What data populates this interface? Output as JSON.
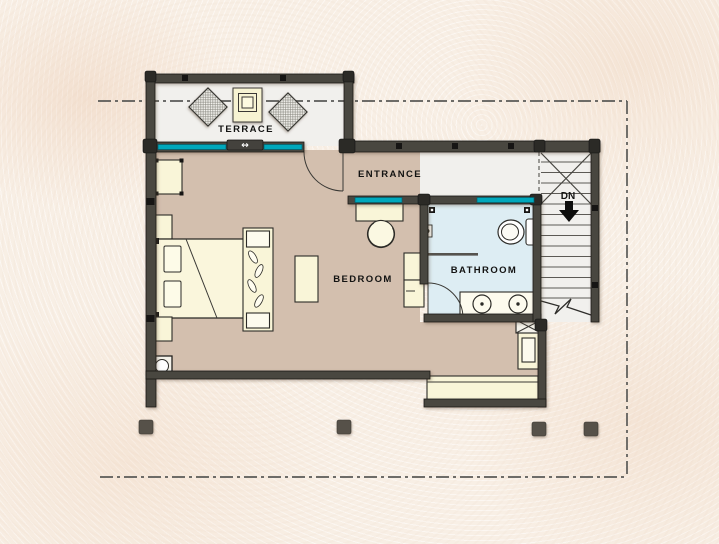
{
  "rooms": {
    "terrace": {
      "label": "TERRACE"
    },
    "entrance": {
      "label": "ENTRANCE"
    },
    "bedroom": {
      "label": "BEDROOM"
    },
    "bathroom": {
      "label": "BATHROOM"
    }
  },
  "stairs": {
    "direction_label": "DN"
  },
  "symbols": {
    "sliding_door_icon": "↔"
  },
  "colors": {
    "paper": "#f8efe5",
    "wall": "#4a4741",
    "floor_light": "#f1f0ed",
    "floor_bedroom": "#d3bfae",
    "floor_bathroom": "#ddedf3",
    "furniture": "#f9f5d8",
    "window_teal": "#00a8bc",
    "boundary_line": "#5a5a57",
    "column": "#56514a",
    "text": "#131312"
  }
}
